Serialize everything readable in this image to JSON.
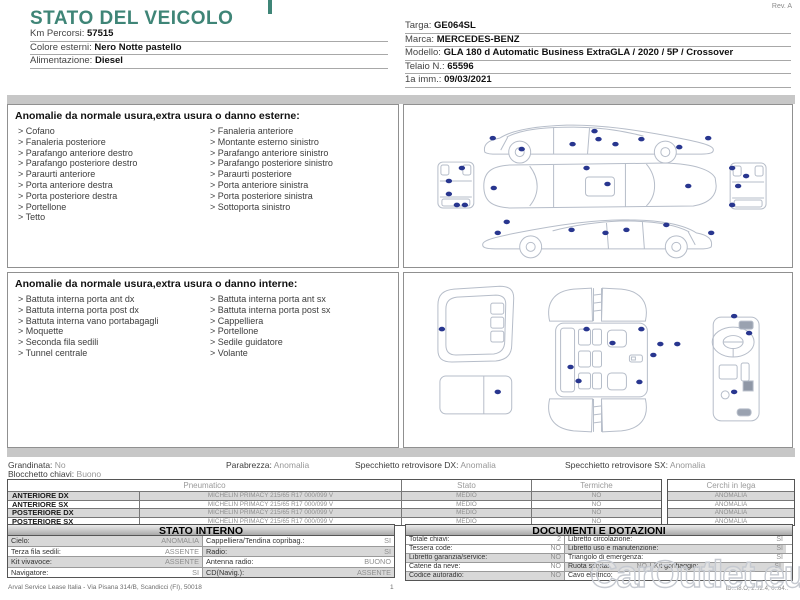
{
  "meta": {
    "title": "STATO DEL VEICOLO",
    "rev": "Rev. A",
    "watermark": "CarOutlet.eu",
    "accent_color": "#3F8577"
  },
  "vehicle": {
    "left": [
      {
        "label": "Km Percorsi:",
        "value": "57515"
      },
      {
        "label": "Colore esterni:",
        "value": "Nero Notte pastello"
      },
      {
        "label": "Alimentazione:",
        "value": "Diesel"
      }
    ],
    "right": [
      {
        "label": "Targa:",
        "value": "GE064SL"
      },
      {
        "label": "Marca:",
        "value": "MERCEDES-BENZ"
      },
      {
        "label": "Modello:",
        "value": "GLA 180 d Automatic Business ExtraGLA / 2020 / 5P / Crossover"
      },
      {
        "label": "Telaio N.:",
        "value": "65596"
      },
      {
        "label": "1a imm.:",
        "value": "09/03/2021"
      }
    ]
  },
  "exterior": {
    "title": "Anomalie da normale usura,extra usura o danno esterne:",
    "left": [
      "Cofano",
      "Fanaleria posteriore",
      "Parafango anteriore destro",
      "Parafango posteriore destro",
      "Paraurti anteriore",
      "Porta anteriore destra",
      "Porta posteriore destra",
      "Portellone",
      "Tetto"
    ],
    "right": [
      "Fanaleria anteriore",
      "Montante esterno sinistro",
      "Parafango anteriore sinistro",
      "Parafango posteriore sinistro",
      "Paraurti posteriore",
      "Porta anteriore sinistra",
      "Porta posteriore sinistra",
      "Sottoporta sinistro"
    ]
  },
  "interior": {
    "title": "Anomalie da normale usura,extra usura o danno interne:",
    "left": [
      "Battuta interna porta ant dx",
      "Battuta interna porta post dx",
      "Battuta interna vano portabagagli",
      "Moquette",
      "Seconda fila sedili",
      "Tunnel centrale"
    ],
    "right": [
      "Battuta interna porta ant sx",
      "Battuta interna porta post sx",
      "Cappelliera",
      "Portellone",
      "Sedile guidatore",
      "Volante"
    ]
  },
  "summary": [
    {
      "label": "Grandinata:",
      "value": "No"
    },
    {
      "label": "Parabrezza:",
      "value": "Anomalia"
    },
    {
      "label": "Specchietto retrovisore DX:",
      "value": "Anomalia"
    },
    {
      "label": "Specchietto retrovisore SX:",
      "value": "Anomalia"
    },
    {
      "label": "Blocchetto chiavi:",
      "value": "Buono"
    }
  ],
  "tyres": {
    "headers": [
      "Pneumatico",
      "Stato",
      "Termiche",
      "Cerchi in lega"
    ],
    "rows": [
      {
        "pos": "ANTERIORE DX",
        "tyre": "MICHELIN PRIMACY 215/65 R17 000/099 V",
        "stato": "MEDIO",
        "termiche": "NO",
        "cerchi": "ANOMALIA"
      },
      {
        "pos": "ANTERIORE SX",
        "tyre": "MICHELIN PRIMACY 215/65 R17 000/099 V",
        "stato": "MEDIO",
        "termiche": "NO",
        "cerchi": "ANOMALIA"
      },
      {
        "pos": "POSTERIORE DX",
        "tyre": "MICHELIN PRIMACY 215/65 R17 000/099 V",
        "stato": "MEDIO",
        "termiche": "NO",
        "cerchi": "ANOMALIA"
      },
      {
        "pos": "POSTERIORE SX",
        "tyre": "MICHELIN PRIMACY 215/65 R17 000/099 V",
        "stato": "MEDIO",
        "termiche": "NO",
        "cerchi": "ANOMALIA"
      }
    ]
  },
  "stato_interno": {
    "title": "STATO INTERNO",
    "rows": [
      [
        {
          "label": "Cielo:",
          "value": "ANOMALIA"
        },
        {
          "label": "Cappelliera/Tendina copribag.:",
          "value": "SI"
        }
      ],
      [
        {
          "label": "Terza fila sedili:",
          "value": "ASSENTE"
        },
        {
          "label": "Radio:",
          "value": "SI"
        }
      ],
      [
        {
          "label": "Kit vivavoce:",
          "value": "ASSENTE"
        },
        {
          "label": "Antenna radio:",
          "value": "BUONO"
        }
      ],
      [
        {
          "label": "Navigatore:",
          "value": "SI"
        },
        {
          "label": "CD(Navig.):",
          "value": "ASSENTE"
        }
      ]
    ]
  },
  "documenti": {
    "title": "DOCUMENTI E DOTAZIONI",
    "rows": [
      [
        {
          "label": "Totale chiavi:",
          "value": "2"
        },
        {
          "label": "Libretto circolazione:",
          "value": "SI"
        }
      ],
      [
        {
          "label": "Tessera code:",
          "value": "NO"
        },
        {
          "label": "Libretto uso e manutenzione:",
          "value": "SI"
        }
      ],
      [
        {
          "label": "Libretto garanzia/service:",
          "value": "NO"
        },
        {
          "label": "Triangolo di emergenza:",
          "value": "SI"
        }
      ],
      [
        {
          "label": "Catene da neve:",
          "value": "NO"
        },
        {
          "label": "Ruota scorta:",
          "value": "NO"
        },
        {
          "label": "Kit gonfiaggio:",
          "value": "SI"
        }
      ],
      [
        {
          "label": "Codice autoradio:",
          "value": "NO"
        },
        {
          "label": "Cavo elettrico:",
          "value": ""
        }
      ]
    ]
  },
  "footer": {
    "company": "Arval Service Lease Italia - Via Pisana 314/B, Scandicci (FI), 50018",
    "page": "1",
    "doc_id": "ID:..f8.O, 2..f2.4, 0..64.."
  },
  "diagrams": {
    "dot_color": "#28368F",
    "exterior_dots": [
      [
        89,
        33
      ],
      [
        118,
        44
      ],
      [
        169,
        39
      ],
      [
        191,
        26
      ],
      [
        195,
        34
      ],
      [
        212,
        39
      ],
      [
        238,
        34
      ],
      [
        276,
        42
      ],
      [
        305,
        33
      ],
      [
        183,
        63
      ],
      [
        90,
        83
      ],
      [
        204,
        79
      ],
      [
        285,
        81
      ],
      [
        58,
        63
      ],
      [
        45,
        76
      ],
      [
        45,
        89
      ],
      [
        53,
        100
      ],
      [
        61,
        100
      ],
      [
        329,
        63
      ],
      [
        343,
        71
      ],
      [
        335,
        81
      ],
      [
        329,
        100
      ],
      [
        103,
        117
      ],
      [
        94,
        128
      ],
      [
        168,
        125
      ],
      [
        202,
        128
      ],
      [
        223,
        125
      ],
      [
        263,
        120
      ],
      [
        308,
        128
      ]
    ],
    "interior_dots": [
      [
        38,
        56
      ],
      [
        94,
        119
      ],
      [
        183,
        56
      ],
      [
        238,
        56
      ],
      [
        209,
        70
      ],
      [
        257,
        71
      ],
      [
        274,
        71
      ],
      [
        250,
        82
      ],
      [
        167,
        94
      ],
      [
        175,
        108
      ],
      [
        236,
        109
      ],
      [
        346,
        60
      ],
      [
        331,
        43
      ],
      [
        331,
        119
      ]
    ]
  }
}
